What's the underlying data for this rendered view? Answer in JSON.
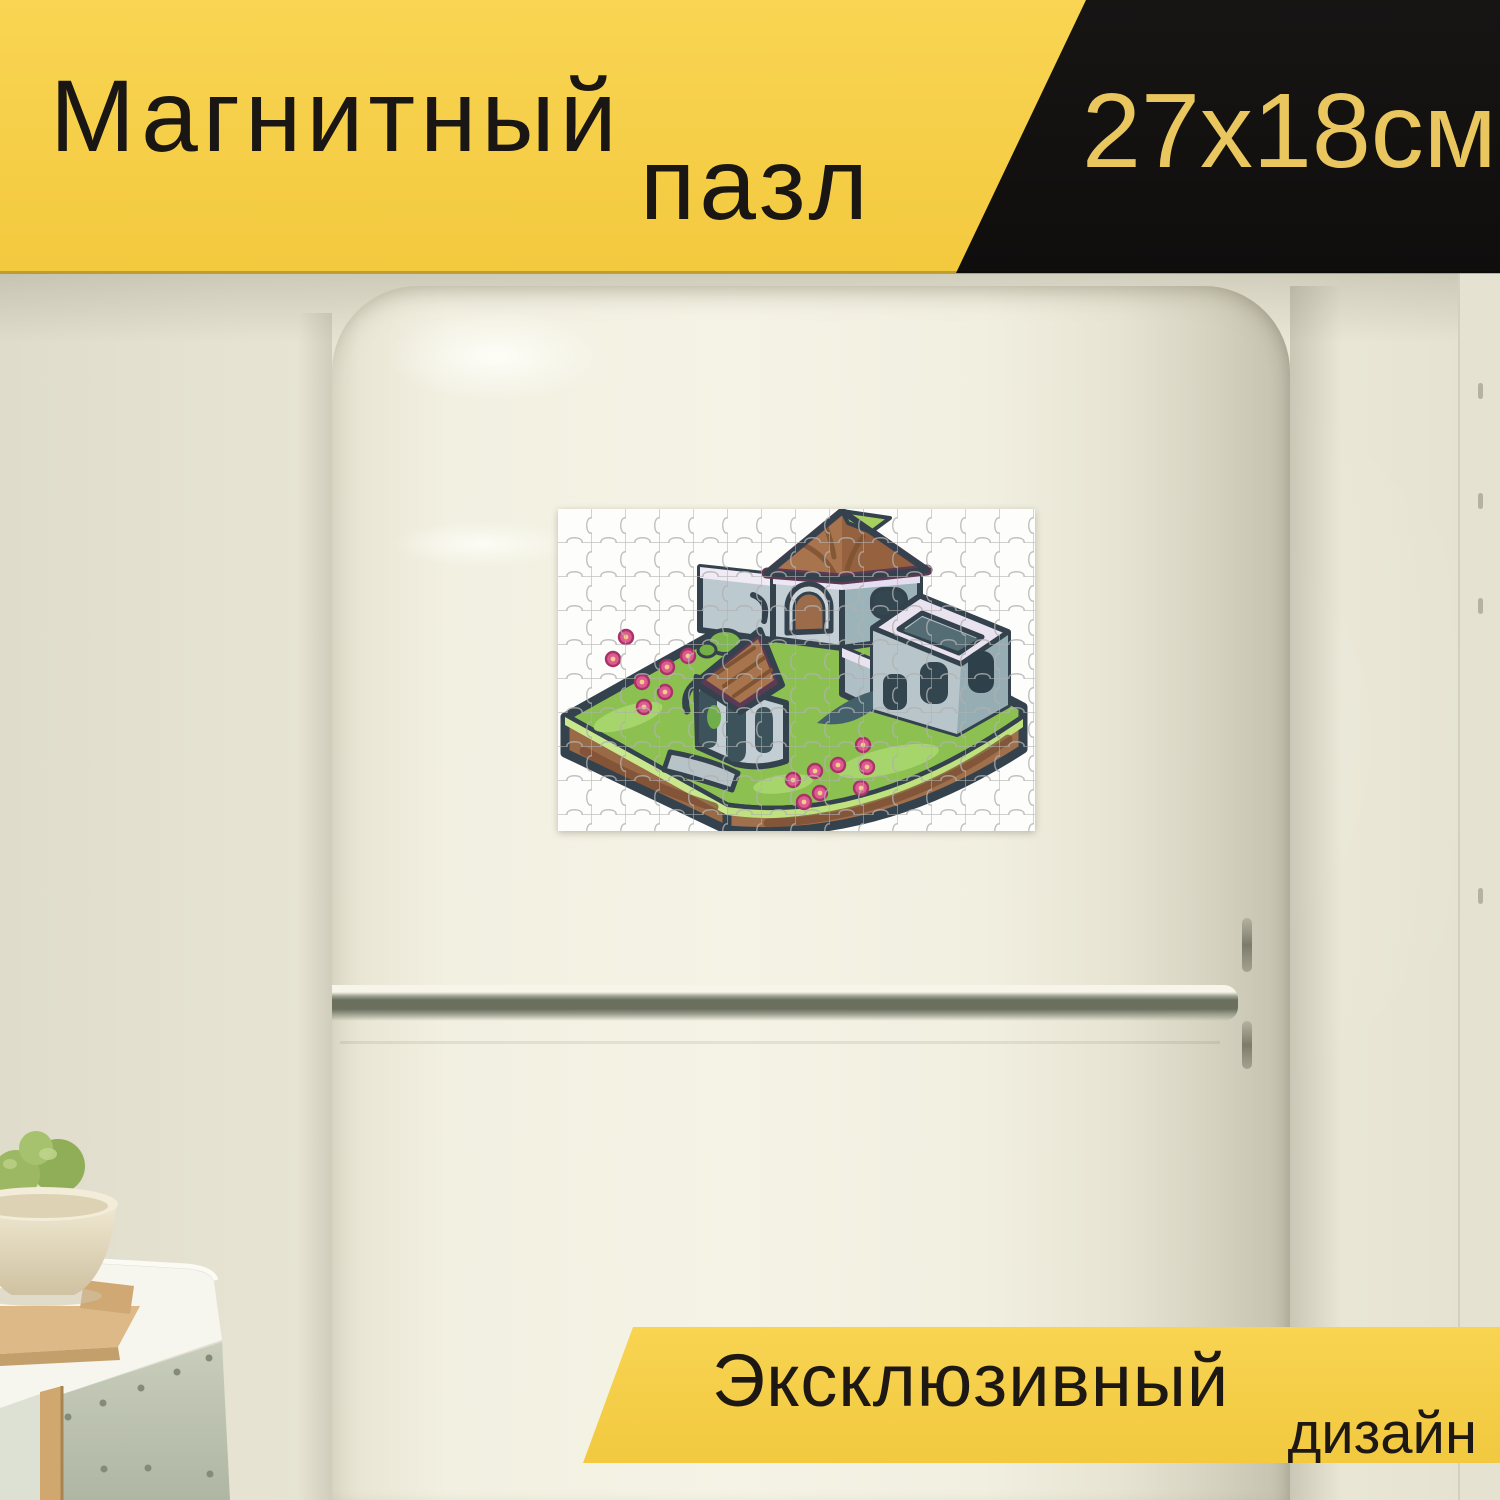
{
  "top_banner": {
    "title_line1": "Магнитный",
    "title_line2": "пазл",
    "size_label": "27x18см",
    "yellow": "#f6cf49",
    "black": "#131211",
    "title_color": "#191614",
    "size_text_color": "#e9c75e"
  },
  "bottom_banner": {
    "line1": "Эксклюзивный",
    "line2": "дизайн",
    "yellow": "#f6cf49",
    "text_color": "#1d1813"
  },
  "magnet": {
    "background": "#fdfdfc",
    "grid_line_color": "#b0b0b0",
    "grid_cols": 14,
    "grid_rows": 9,
    "palette": {
      "outline": "#33424d",
      "wall_light": "#c3cfd4",
      "wall_mid": "#9db3ba",
      "coping": "#ece7f2",
      "roof_brown": "#a8744d",
      "roof_trim": "#5d3a54",
      "roof_accent": "#a8d05f",
      "grass": "#8cc152",
      "grass_light": "#a6d56b",
      "dirt": "#9a6a46",
      "dirt_dark": "#7b4e33",
      "flower": "#dc5b91",
      "flower_center": "#f6c98d",
      "window": "#34464f"
    }
  },
  "photo": {
    "wall": "#eae7d6",
    "fridge": "#f2f0e1",
    "fridge_side": "#c9c6b4",
    "seam": "#6b6f5e",
    "counter": "#f6f5ee",
    "cabinet": "#c8cdbb",
    "wood": "#dcb987",
    "bowl": "#eee6cf",
    "apple": "#95ad57"
  }
}
